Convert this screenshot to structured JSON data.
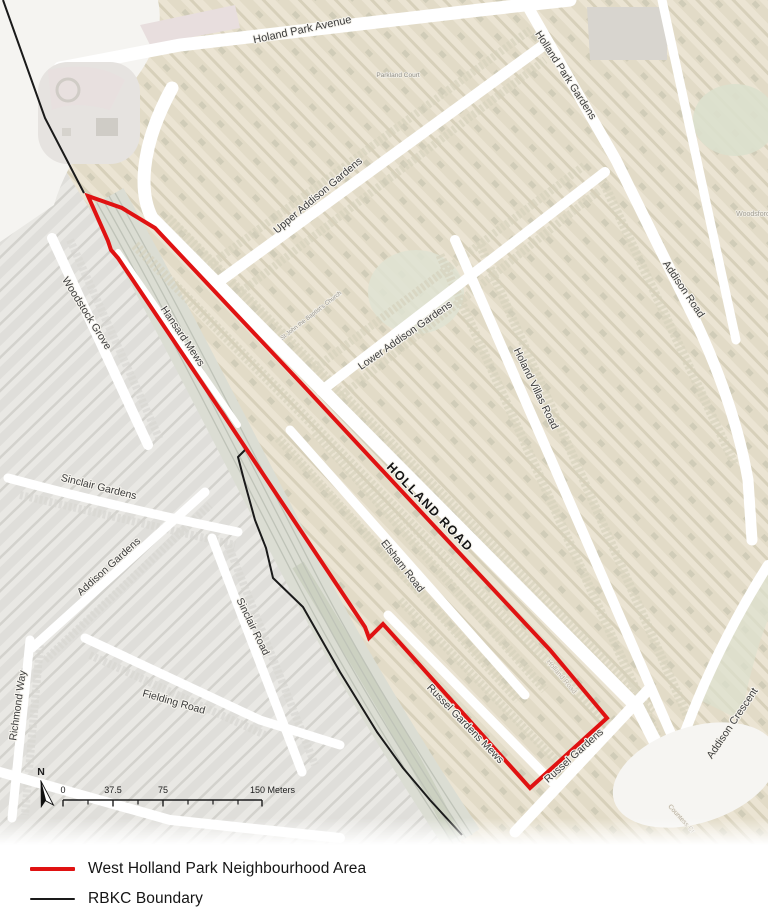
{
  "map": {
    "boundaries": {
      "neighbourhood": {
        "name": "West Holland Park Neighbourhood Area",
        "color": "#e01212",
        "width": 4,
        "closed": true,
        "points": [
          [
            88,
            196
          ],
          [
            122,
            208
          ],
          [
            155,
            228
          ],
          [
            300,
            382
          ],
          [
            450,
            543
          ],
          [
            550,
            650
          ],
          [
            607,
            718
          ],
          [
            530,
            788
          ],
          [
            383,
            624
          ],
          [
            369,
            638
          ],
          [
            365,
            627
          ],
          [
            225,
            417
          ],
          [
            118,
            258
          ],
          [
            111,
            250
          ],
          [
            108,
            241
          ]
        ]
      },
      "rbkc": {
        "name": "RBKC Boundary",
        "color": "#1a1a1a",
        "width": 2,
        "segments": [
          [
            [
              3,
              0
            ],
            [
              45,
              118
            ],
            [
              84,
              193
            ]
          ],
          [
            [
              246,
              449
            ],
            [
              238,
              457
            ],
            [
              244,
              480
            ],
            [
              255,
              520
            ],
            [
              266,
              548
            ],
            [
              273,
              578
            ],
            [
              303,
              607
            ],
            [
              340,
              672
            ],
            [
              377,
              732
            ],
            [
              403,
              768
            ],
            [
              430,
              800
            ],
            [
              462,
              835
            ]
          ]
        ]
      }
    },
    "street_labels": [
      {
        "id": "holland-park-avenue",
        "text": "Holand Park Avenue",
        "x": 303,
        "y": 33,
        "rot": -12,
        "size": 11,
        "weight": 400,
        "color": "#3b3b3b"
      },
      {
        "id": "holland-park-gardens",
        "text": "Holland Park Gardens",
        "x": 563,
        "y": 77,
        "rot": 57,
        "size": 10.5,
        "weight": 400,
        "color": "#3b3b3b"
      },
      {
        "id": "upper-addison-gardens",
        "text": "Upper Addison Gardens",
        "x": 320,
        "y": 198,
        "rot": -40,
        "size": 10.5,
        "weight": 400,
        "color": "#3b3b3b"
      },
      {
        "id": "lower-addison-gardens",
        "text": "Lower Addison Gardens",
        "x": 407,
        "y": 338,
        "rot": -35,
        "size": 10.5,
        "weight": 400,
        "color": "#3b3b3b"
      },
      {
        "id": "addison-road",
        "text": "Addison Road",
        "x": 681,
        "y": 291,
        "rot": 56,
        "size": 10.5,
        "weight": 400,
        "color": "#3b3b3b"
      },
      {
        "id": "woodstock-grove",
        "text": "Woodstock Grove",
        "x": 84,
        "y": 315,
        "rot": 58,
        "size": 10.5,
        "weight": 400,
        "color": "#3b3b3b"
      },
      {
        "id": "hansard-mews",
        "text": "Hansard Mews",
        "x": 180,
        "y": 338,
        "rot": 56,
        "size": 10.5,
        "weight": 400,
        "color": "#3b3b3b"
      },
      {
        "id": "holland-villas-road",
        "text": "Holand Villas Road",
        "x": 533,
        "y": 390,
        "rot": 64,
        "size": 10.5,
        "weight": 400,
        "color": "#3b3b3b"
      },
      {
        "id": "holland-road",
        "text": "HOLLAND ROAD",
        "x": 427,
        "y": 510,
        "rot": 46,
        "size": 12.5,
        "weight": 700,
        "color": "#141414",
        "ls": 1.4
      },
      {
        "id": "elsham-road",
        "text": "Elsham Road",
        "x": 400,
        "y": 568,
        "rot": 52,
        "size": 10.5,
        "weight": 400,
        "color": "#3b3b3b"
      },
      {
        "id": "sinclair-gardens",
        "text": "Sinclair Gardens",
        "x": 98,
        "y": 490,
        "rot": 14,
        "size": 10.5,
        "weight": 400,
        "color": "#3b3b3b"
      },
      {
        "id": "addison-gardens",
        "text": "Addison Gardens",
        "x": 111,
        "y": 569,
        "rot": -42,
        "size": 10.5,
        "weight": 400,
        "color": "#3b3b3b"
      },
      {
        "id": "sinclair-road",
        "text": "Sinclair Road",
        "x": 250,
        "y": 628,
        "rot": 64,
        "size": 10.5,
        "weight": 400,
        "color": "#3b3b3b"
      },
      {
        "id": "fielding-road",
        "text": "Fielding Road",
        "x": 173,
        "y": 705,
        "rot": 16,
        "size": 10.5,
        "weight": 400,
        "color": "#3b3b3b"
      },
      {
        "id": "richmond-way",
        "text": "Richmond Way",
        "x": 21,
        "y": 706,
        "rot": -82,
        "size": 10.5,
        "weight": 400,
        "color": "#3b3b3b"
      },
      {
        "id": "russel-gardens-mews",
        "text": "Russel Gardens Mews",
        "x": 463,
        "y": 726,
        "rot": 46,
        "size": 10.5,
        "weight": 400,
        "color": "#3b3b3b"
      },
      {
        "id": "russel-gardens",
        "text": "Russel Gardens",
        "x": 576,
        "y": 758,
        "rot": -42,
        "size": 10.5,
        "weight": 400,
        "color": "#3b3b3b"
      },
      {
        "id": "addison-crescent",
        "text": "Addison Crescent",
        "x": 735,
        "y": 725,
        "rot": -56,
        "size": 10.5,
        "weight": 400,
        "color": "#3b3b3b"
      }
    ],
    "faint_labels": [
      {
        "id": "parkland-court",
        "text": "Parkland Court",
        "x": 398,
        "y": 77,
        "rot": 0,
        "size": 6.5,
        "weight": 400,
        "color": "#8f8c82"
      },
      {
        "id": "st-john-the-baptists-church",
        "text": "St John the Baptist's Church",
        "x": 312,
        "y": 317,
        "rot": -38,
        "size": 6,
        "weight": 400,
        "color": "#97938a"
      },
      {
        "id": "woodsford",
        "text": "Woodsford",
        "x": 753,
        "y": 216,
        "rot": 0,
        "size": 7,
        "weight": 400,
        "color": "#a09c90"
      },
      {
        "id": "holland-road-faint",
        "text": "Holland Road",
        "x": 560,
        "y": 678,
        "rot": 50,
        "size": 7,
        "weight": 400,
        "color": "#b9b2a3"
      },
      {
        "id": "countess-crescent",
        "text": "Countess Cr",
        "x": 680,
        "y": 820,
        "rot": 48,
        "size": 6.5,
        "weight": 400,
        "color": "#b4ab9c"
      }
    ],
    "scale_bar": {
      "y": 800,
      "x_start": 63,
      "x_end": 262,
      "major_ticks": [
        {
          "x": 63,
          "label": "0"
        },
        {
          "x": 113,
          "label": "37.5"
        },
        {
          "x": 163,
          "label": "75"
        },
        {
          "x": 262,
          "label": "150 Meters"
        }
      ],
      "minor_ticks": [
        88,
        138,
        188,
        213,
        238
      ]
    },
    "north_arrow": {
      "label": "N"
    }
  },
  "legend": {
    "items": [
      {
        "label": "West Holland Park Neighbourhood Area",
        "color": "#e01212",
        "thickness": 4
      },
      {
        "label": "RBKC Boundary",
        "color": "#1a1a1a",
        "thickness": 1.7
      }
    ]
  }
}
